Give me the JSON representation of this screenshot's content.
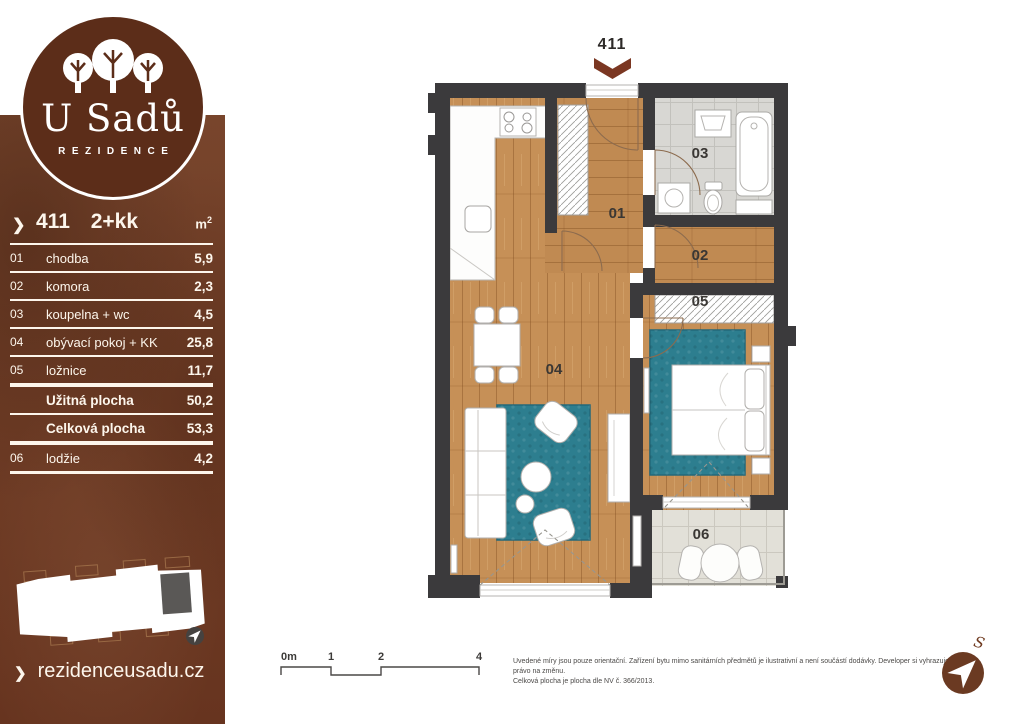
{
  "sidebar": {
    "logo": {
      "title": "U Sadů",
      "subtitle": "REZIDENCE"
    },
    "unit": {
      "chevron": "❯",
      "number": "411",
      "layout": "2+kk",
      "area_unit": "m",
      "area_unit_sup": "2"
    },
    "rooms": [
      {
        "num": "01",
        "name": "chodba",
        "area": "5,9"
      },
      {
        "num": "02",
        "name": "komora",
        "area": "2,3"
      },
      {
        "num": "03",
        "name": "koupelna + wc",
        "area": "4,5"
      },
      {
        "num": "04",
        "name": "obývací pokoj + KK",
        "area": "25,8"
      },
      {
        "num": "05",
        "name": "ložnice",
        "area": "11,7"
      }
    ],
    "totals": [
      {
        "name": "Užitná plocha",
        "area": "50,2"
      },
      {
        "name": "Celková plocha",
        "area": "53,3"
      }
    ],
    "extra": [
      {
        "num": "06",
        "name": "lodžie",
        "area": "4,2"
      }
    ],
    "website": {
      "chevron": "❯",
      "url": "rezidenceusadu.cz"
    }
  },
  "plan": {
    "unit_number": "411",
    "labels": {
      "hallway": "01",
      "storage": "02",
      "bathroom": "03",
      "living": "04",
      "bedroom": "05",
      "loggia": "06"
    }
  },
  "scalebar": {
    "labels": [
      "0m",
      "1",
      "2",
      "4"
    ]
  },
  "footer": {
    "disclaimer_line1": "Uvedené míry jsou pouze orientační. Zařízení bytu mimo sanitárních předmětů je ilustrativní a není součástí dodávky. Developer si vyhrazuje",
    "disclaimer_line2": "právo na změnu.",
    "disclaimer_line3": "Celková plocha je plocha dle NV č. 366/2013."
  },
  "compass": {
    "north_label": "S"
  },
  "colors": {
    "sidebar_brown": "#73412a",
    "logo_brown": "#5c2d19",
    "wall": "#3b3a3c",
    "wood": "#c69057",
    "rug_teal": "#2d7e8f",
    "bath_tile": "#d8d7d3",
    "loggia_tile": "#e2e0d8",
    "arrow_brown": "#7b3722"
  }
}
